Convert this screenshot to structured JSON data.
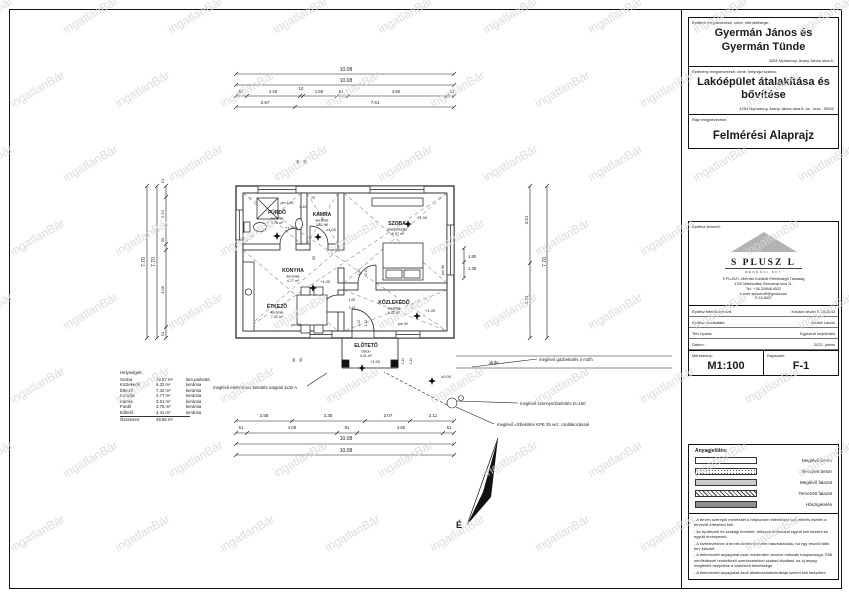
{
  "watermark": {
    "text": "ingatlanBár"
  },
  "title_block": {
    "client_label": "Építtető megnevezése, címe, elérhetősége:",
    "client_name": "Gyermán János és Gyermán Tünde",
    "client_address": "4254 Nyíradony, Arany János utca 6.",
    "project_label": "Építmény megnevezése, címe, helyrajzi száma:",
    "project_name": "Lakóépület átalakítása és bővítése",
    "project_address": "4254 Nyíradony, Arany János utca 6. sz., hrsz.: 559/2",
    "drawing_label": "Rajz megnevezése:",
    "drawing_name": "Felmérési Alaprajz",
    "designer_label": "Építész tervező:",
    "logo_name": "S PLUSZ L",
    "logo_sub": "MÉRNÖKI KFT",
    "company_lines": [
      "S PLUSZ L Mérnöki Korlátolt Felelősségű Társaság",
      "4700 Mátészalka, Bercsényi utca 11.",
      "Tel.: +36-30/648-8532",
      "e-mail: spluszl.kft@gmail.com",
      "É-15-5637"
    ],
    "rows": [
      {
        "label": "Építész felelős tervező:",
        "value": "Kovács István É-15-0543"
      },
      {
        "label": "Építész munkatárs:",
        "value": "Szutöli László"
      },
      {
        "label": "Terv típusa:",
        "value": "Egyszerű bejelentés"
      },
      {
        "label": "Dátum:",
        "value": "2022. június"
      }
    ],
    "scale_label": "Méretarány:",
    "scale_value": "M1:100",
    "number_label": "Rajzszám:",
    "number_value": "F-1"
  },
  "materials": {
    "title": "Anyagjelölés:",
    "items": [
      {
        "label": "Meglévő beton",
        "pattern": "empty"
      },
      {
        "label": "Tervezett beton",
        "pattern": "stipple"
      },
      {
        "label": "Meglévő falazat",
        "pattern": "solid-light"
      },
      {
        "label": "Tervezett falazat",
        "pattern": "hatch"
      },
      {
        "label": "Hőszigetelés",
        "pattern": "solid-dark"
      }
    ],
    "notes": [
      "- A terven szereplő méreteket a helyszínen ellenőrizni kell, eltérés esetén a tervezőt értesíteni kell.",
      "- Az építészeti és szakági terveket, műszaki leírásokat együtt kell kezelni és együtt érvényesek.",
      "- A kivitelezéshez a tervek kiviteli tervként használandók, ha egy részről több terv készült.",
      "- A betervezett anyagokat csak mindenben azonos műszaki tulajdonságú, ÉMI minősítéssel rendelkező szerkezetekkel szabad kiváltani, az új anyag megfelelő beépítése a kivitelező felelőssége.",
      "- A betervezett anyagokat azok alkalmazástechnikája szerint kell beépíteni."
    ]
  },
  "schedule": {
    "title": "Helyiségek:",
    "rows": [
      [
        "Szoba",
        "19.57 m²",
        "lam.parketta"
      ],
      [
        "Közlekedő",
        "6.32 m²",
        "kerámia"
      ],
      [
        "Étkező",
        "7.42 m²",
        "kerámia"
      ],
      [
        "Konyha",
        "4.77 m²",
        "kerámia"
      ],
      [
        "Kamra",
        "3.61 m²",
        "kerámia"
      ],
      [
        "Fürdő",
        "3.75 m²",
        "kerámia"
      ],
      [
        "Előtető",
        "4.41 m²",
        "kerámia"
      ]
    ],
    "total_label": "Összesen:",
    "total_value": "49.85 m²"
  },
  "plan": {
    "north_label": "É",
    "rooms": [
      {
        "name": "FÜRDŐ",
        "floor": "kerámia",
        "area": "3.75 m²",
        "x": 277,
        "y": 214
      },
      {
        "name": "KAMRA",
        "floor": "kerámia",
        "area": "3.61 m²",
        "x": 322,
        "y": 216
      },
      {
        "name": "SZOBA",
        "floor": "lam.parketta",
        "area": "19.57 m²",
        "x": 397,
        "y": 225
      },
      {
        "name": "KONYHA",
        "floor": "kerámia",
        "area": "4.77 m²",
        "x": 293,
        "y": 272
      },
      {
        "name": "ÉTKEZŐ",
        "floor": "kerámia",
        "area": "7.42 m²",
        "x": 277,
        "y": 308
      },
      {
        "name": "KÖZLEKEDŐ",
        "floor": "kerámia",
        "area": "6.32 m²",
        "x": 394,
        "y": 304
      },
      {
        "name": "ELŐTETŐ",
        "floor": "beton",
        "area": "4.41 m²",
        "x": 366,
        "y": 347
      }
    ],
    "level_marks": [
      {
        "x": 277,
        "y": 236
      },
      {
        "x": 318,
        "y": 237
      },
      {
        "x": 408,
        "y": 224
      },
      {
        "x": 313,
        "y": 288
      },
      {
        "x": 417,
        "y": 316
      },
      {
        "x": 362,
        "y": 368
      },
      {
        "x": 432,
        "y": 381
      }
    ],
    "texts": [
      {
        "t": "10.08",
        "x": 346,
        "y": 71,
        "s": 5
      },
      {
        "t": "10.08",
        "x": 346,
        "y": 82,
        "s": 5
      },
      {
        "t": "51",
        "x": 241,
        "y": 93,
        "s": 4.2
      },
      {
        "t": "2.40",
        "x": 273,
        "y": 93,
        "s": 4.2
      },
      {
        "t": "10",
        "x": 301,
        "y": 90,
        "s": 4.2
      },
      {
        "t": "1.55",
        "x": 319,
        "y": 93,
        "s": 4.2
      },
      {
        "t": "51",
        "x": 341,
        "y": 93,
        "s": 4.2
      },
      {
        "t": "4.50",
        "x": 396,
        "y": 93,
        "s": 4.2
      },
      {
        "t": "51",
        "x": 452,
        "y": 93,
        "s": 4.2
      },
      {
        "t": "2.67",
        "x": 265,
        "y": 104,
        "s": 4.5
      },
      {
        "t": "7.61",
        "x": 375,
        "y": 104,
        "s": 4.5
      },
      {
        "t": "2.55",
        "x": 264,
        "y": 417,
        "s": 4.5
      },
      {
        "t": "3.35",
        "x": 328,
        "y": 417,
        "s": 4.5
      },
      {
        "t": "2.07",
        "x": 388,
        "y": 417,
        "s": 4.5
      },
      {
        "t": "2.11",
        "x": 433,
        "y": 417,
        "s": 4.5
      },
      {
        "t": "51",
        "x": 241,
        "y": 429,
        "s": 4.2
      },
      {
        "t": "4.09",
        "x": 292,
        "y": 429,
        "s": 4.2
      },
      {
        "t": "91",
        "x": 347,
        "y": 429,
        "s": 4.2
      },
      {
        "t": "4.50",
        "x": 401,
        "y": 429,
        "s": 4.2
      },
      {
        "t": "51",
        "x": 449,
        "y": 429,
        "s": 4.2
      },
      {
        "t": "10.08",
        "x": 346,
        "y": 440,
        "s": 5
      },
      {
        "t": "10.08",
        "x": 346,
        "y": 452,
        "s": 5
      },
      {
        "t": "7.70",
        "x": 145,
        "y": 262,
        "s": 5,
        "r": -90
      },
      {
        "t": "7.70",
        "x": 155,
        "y": 262,
        "s": 5,
        "r": -90
      },
      {
        "t": "51",
        "x": 164,
        "y": 181,
        "s": 4,
        "r": -90
      },
      {
        "t": "2.13",
        "x": 164,
        "y": 214,
        "s": 4,
        "r": -90
      },
      {
        "t": "30",
        "x": 164,
        "y": 240,
        "s": 4,
        "r": -90
      },
      {
        "t": "4.08",
        "x": 164,
        "y": 290,
        "s": 4,
        "r": -90
      },
      {
        "t": "51",
        "x": 164,
        "y": 334,
        "s": 4,
        "r": -90
      },
      {
        "t": "3.51",
        "x": 528,
        "y": 220,
        "s": 4.5,
        "r": -90
      },
      {
        "t": "3.31",
        "x": 528,
        "y": 300,
        "s": 4.5,
        "r": -90
      },
      {
        "t": "7.70",
        "x": 546,
        "y": 262,
        "s": 5,
        "r": -90
      },
      {
        "t": "1.80",
        "x": 468,
        "y": 258,
        "s": 4.2,
        "a": "start"
      },
      {
        "t": "1.35",
        "x": 468,
        "y": 270,
        "s": 4.2,
        "a": "start"
      },
      {
        "t": "pm 90",
        "x": 444,
        "y": 270,
        "s": 3.6,
        "r": -90
      },
      {
        "t": "90",
        "x": 299,
        "y": 162,
        "s": 3.6,
        "r": -90
      },
      {
        "t": "60",
        "x": 306,
        "y": 162,
        "s": 3.6,
        "r": -90
      },
      {
        "t": "pm 1.90",
        "x": 287,
        "y": 204,
        "s": 3.6
      },
      {
        "t": "75",
        "x": 313,
        "y": 199,
        "s": 3.6
      },
      {
        "t": "2.40",
        "x": 303,
        "y": 208,
        "s": 3.6
      },
      {
        "t": "85",
        "x": 315,
        "y": 258,
        "s": 3.4,
        "r": -90
      },
      {
        "t": "1.00",
        "x": 360,
        "y": 272,
        "s": 3.4,
        "r": -90
      },
      {
        "t": "2.10",
        "x": 367,
        "y": 272,
        "s": 3.4,
        "r": -90
      },
      {
        "t": "1.00",
        "x": 352,
        "y": 301,
        "s": 3.4
      },
      {
        "t": "2.10",
        "x": 352,
        "y": 309,
        "s": 3.4
      },
      {
        "t": "1.00",
        "x": 360,
        "y": 323,
        "s": 3.4,
        "r": -90
      },
      {
        "t": "2.10",
        "x": 367,
        "y": 323,
        "s": 3.4,
        "r": -90
      },
      {
        "t": "pm 95",
        "x": 296,
        "y": 326,
        "s": 3.6
      },
      {
        "t": "pm 90",
        "x": 403,
        "y": 325,
        "s": 3.6
      },
      {
        "t": "86",
        "x": 295,
        "y": 360,
        "s": 3.4,
        "r": -90
      },
      {
        "t": "96",
        "x": 302,
        "y": 360,
        "s": 3.4,
        "r": -90
      },
      {
        "t": "1.20",
        "x": 404,
        "y": 361,
        "s": 3.4,
        "r": -90
      },
      {
        "t": "1.20",
        "x": 412,
        "y": 361,
        "s": 3.4,
        "r": -90
      },
      {
        "t": "+1.00",
        "x": 290,
        "y": 229,
        "s": 4
      },
      {
        "t": "±1.00",
        "x": 331,
        "y": 231,
        "s": 4
      },
      {
        "t": "+1.00",
        "x": 422,
        "y": 219,
        "s": 4
      },
      {
        "t": "+1.00",
        "x": 325,
        "y": 283,
        "s": 4
      },
      {
        "t": "+1.00",
        "x": 430,
        "y": 312,
        "s": 4
      },
      {
        "t": "+1.00",
        "x": 375,
        "y": 363,
        "s": 4
      },
      {
        "t": "±0.00",
        "x": 446,
        "y": 378,
        "s": 4
      },
      {
        "t": "meglévő elektromos bekötés nappali 1x32 A",
        "x": 213,
        "y": 389,
        "s": 4.3,
        "a": "start",
        "n": "annotation-electric"
      },
      {
        "t": "meglévő gázbekötés 4 m3/h",
        "x": 539,
        "y": 361,
        "s": 4.3,
        "a": "start",
        "n": "annotation-gas"
      },
      {
        "t": "meglévő szennyvízbekötés D=160",
        "x": 520,
        "y": 405,
        "s": 4.3,
        "a": "start",
        "n": "annotation-sewer"
      },
      {
        "t": "meglévő vízbekötés KPE 25 vez. csatlakozással",
        "x": 497,
        "y": 426,
        "s": 4.3,
        "a": "start",
        "n": "annotation-water"
      },
      {
        "t": "járda",
        "x": 489,
        "y": 364,
        "s": 4.3,
        "a": "start",
        "n": "label-sidewalk"
      }
    ]
  }
}
